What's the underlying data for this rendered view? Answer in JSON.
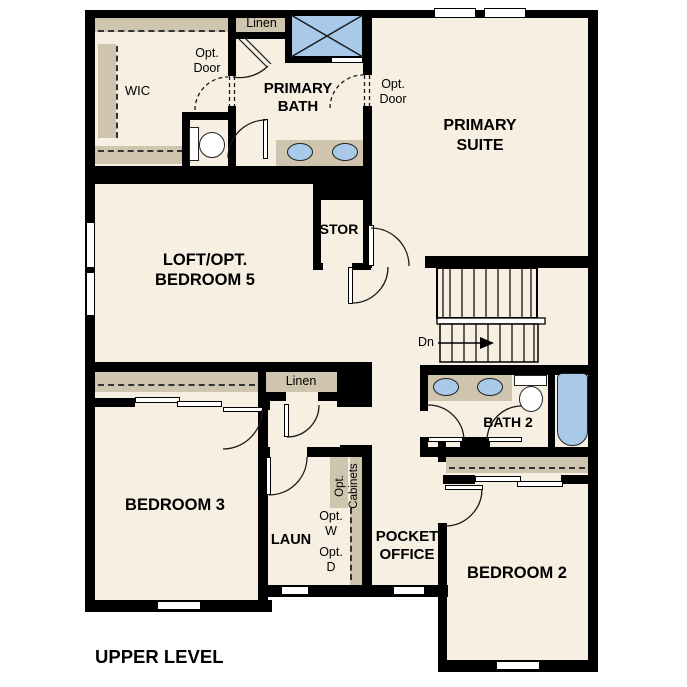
{
  "floor_plan": {
    "level_label": "UPPER LEVEL",
    "rooms": {
      "wic": "WIC",
      "linen_top": "Linen",
      "primary_bath": {
        "line1": "PRIMARY",
        "line2": "BATH"
      },
      "primary_suite": {
        "line1": "PRIMARY",
        "line2": "SUITE"
      },
      "storage": "STOR",
      "loft": {
        "line1": "LOFT/OPT.",
        "line2": "BEDROOM 5"
      },
      "linen_hall": "Linen",
      "bath2": "BATH 2",
      "bedroom3": "BEDROOM 3",
      "laundry": "LAUN",
      "pocket_office": {
        "line1": "POCKET",
        "line2": "OFFICE"
      },
      "bedroom2": "BEDROOM 2"
    },
    "annotations": {
      "opt_door_wic": {
        "line1": "Opt.",
        "line2": "Door"
      },
      "opt_door_suite": {
        "line1": "Opt.",
        "line2": "Door"
      },
      "stairs_down": "Dn",
      "opt_washer": {
        "line1": "Opt.",
        "line2": "W"
      },
      "opt_dryer": {
        "line1": "Opt.",
        "line2": "D"
      },
      "opt_cabinets": {
        "line1": "Opt.",
        "line2": "Cabinets"
      }
    },
    "colors": {
      "floor": "#f6efe2",
      "casework_tan": "#cfc5ae",
      "fixture_blue": "#a9c9e9",
      "wall": "#000000",
      "background": "#ffffff"
    }
  }
}
